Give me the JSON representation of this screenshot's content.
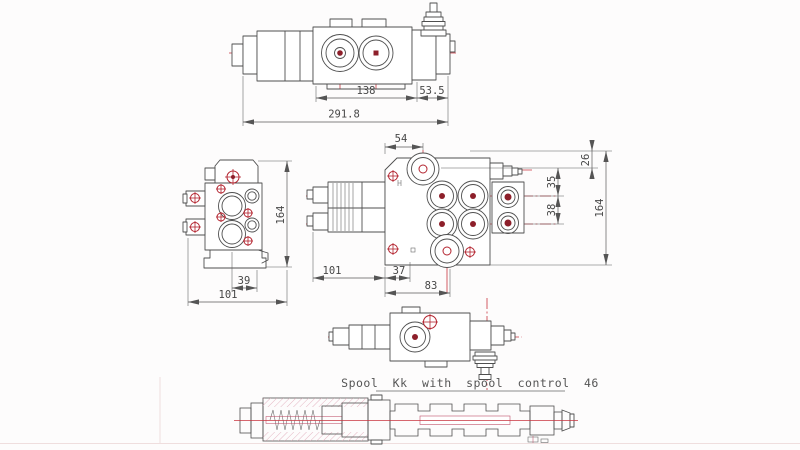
{
  "note": {
    "spool_label": "Spool Kk with spool control 46"
  },
  "dimensions": {
    "side_view": {
      "body_width": "138",
      "cap_width": "53.5",
      "total_width": "291.8"
    },
    "end_view": {
      "height": "164",
      "port_offset": "39",
      "width": "101"
    },
    "plan_view": {
      "p_port_offset": "54",
      "spool_cap_length": "101",
      "offset_a": "37",
      "offset_b": "83",
      "top_offset": "26",
      "port_a_offset": "35",
      "port_spacing": "38",
      "height": "164"
    }
  },
  "colors": {
    "line": "#4f4f4f",
    "centerline": "#c8353f",
    "hatch": "#dfa3b4",
    "hatch_dense": "#c77791",
    "accent_red": "#b3232e",
    "dim_text": "#474747",
    "background": "#fdfcfc"
  }
}
